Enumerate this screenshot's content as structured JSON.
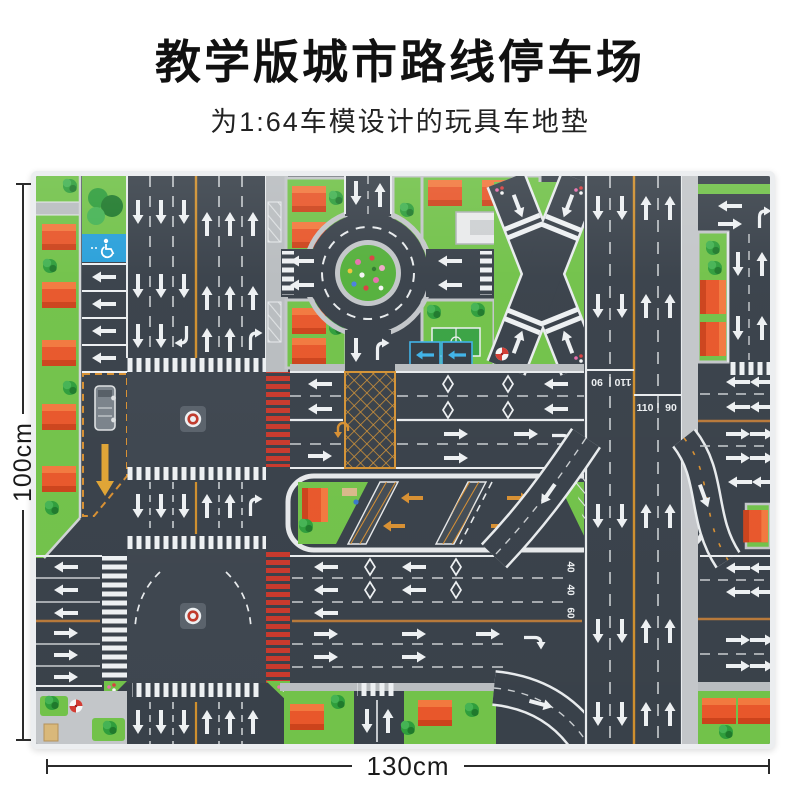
{
  "header": {
    "title": "教学版城市路线停车场",
    "subtitle": "为1:64车模设计的玩具车地垫"
  },
  "dimension_labels": {
    "height": "100cm",
    "width": "130cm"
  },
  "mat_markings": {
    "highway_speed_left": "110",
    "highway_speed_right": "90",
    "roadc_speed_lane1": "40",
    "roadc_speed_lane2": "40",
    "roadc_speed_lane3": "60"
  },
  "colors": {
    "road": "#39414a",
    "grass": "#72c24a",
    "roof_orange": "#e8572b",
    "marking_white": "#edf0f2",
    "lane_yellow": "#cf8f2e",
    "divider_tan": "#b8793a",
    "handicap_blue": "#29a0da",
    "parking_blue": "#3fb3e8",
    "crosswalk_red": "#c8392c",
    "sidewalk_gray": "#c3c6c9",
    "pool_blue": "#a5d9ec"
  }
}
